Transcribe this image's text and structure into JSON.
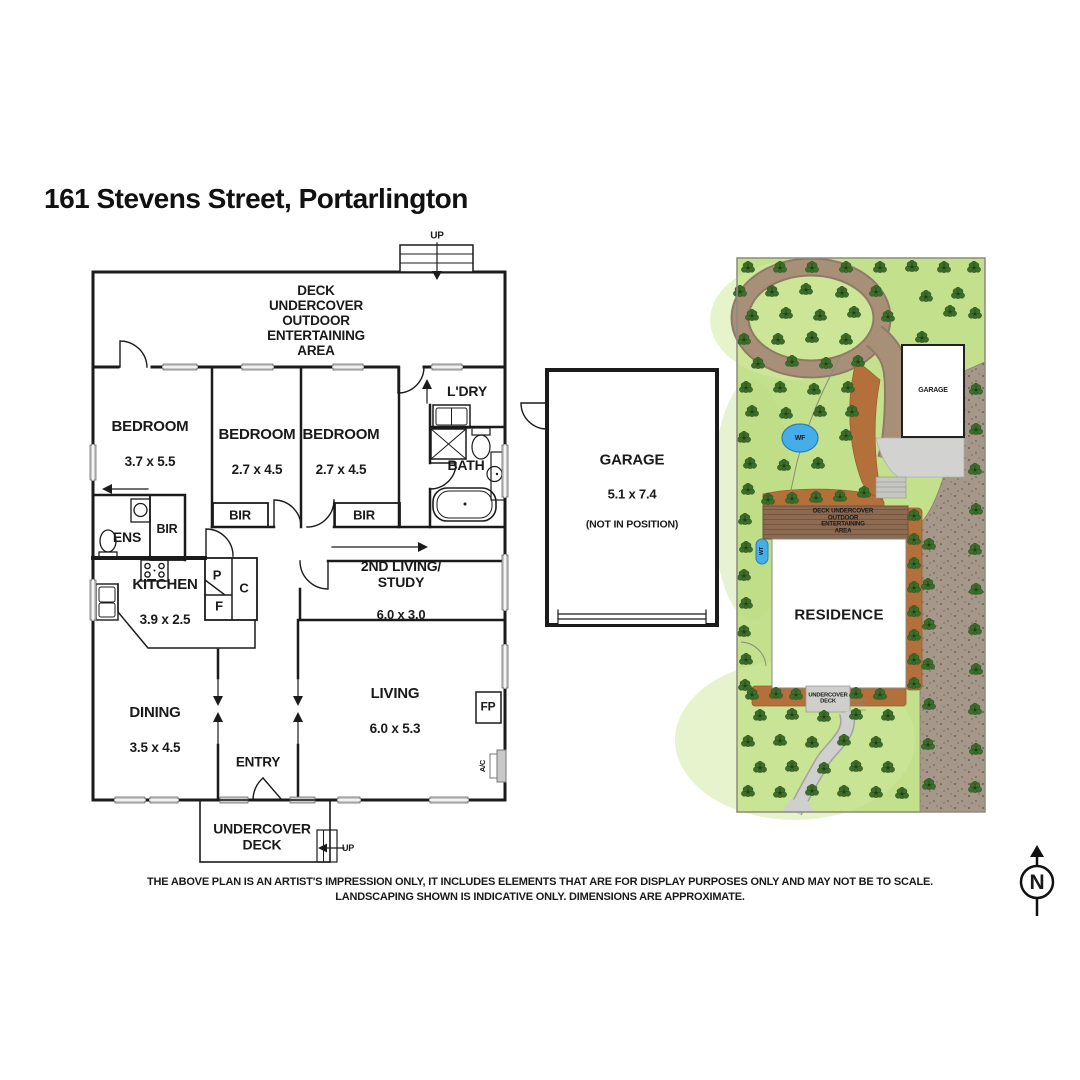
{
  "page_title": "161 Stevens Street, Portarlington",
  "floorplan": {
    "deck_area": "DECK\nUNDERCOVER\nOUTDOOR\nENTERTAINING\nAREA",
    "stairs_top": "UP",
    "stairs_bottom": "UP",
    "rooms": {
      "bedroom1": {
        "name": "BEDROOM",
        "dims": "3.7 x 5.5"
      },
      "bedroom2": {
        "name": "BEDROOM",
        "dims": "2.7 x 4.5"
      },
      "bedroom3": {
        "name": "BEDROOM",
        "dims": "2.7 x 4.5"
      },
      "kitchen": {
        "name": "KITCHEN",
        "dims": "3.9 x 2.5"
      },
      "dining": {
        "name": "DINING",
        "dims": "3.5 x 4.5"
      },
      "living": {
        "name": "LIVING",
        "dims": "6.0 x 5.3"
      },
      "second_living": {
        "name": "2ND LIVING/\nSTUDY",
        "dims": "6.0 x 3.0"
      },
      "garage": {
        "name": "GARAGE",
        "dims": "5.1 x 7.4",
        "note": "(NOT IN POSITION)"
      }
    },
    "labels": {
      "ens": "ENS",
      "bir": "BIR",
      "ldry": "L'DRY",
      "bath": "BATH",
      "pantry": "P",
      "fridge": "F",
      "cupboard": "C",
      "entry": "ENTRY",
      "fireplace": "FP",
      "aircon": "A/C",
      "undercover_deck": "UNDERCOVER\nDECK"
    }
  },
  "siteplan": {
    "labels": {
      "garage": "GARAGE",
      "residence": "RESIDENCE",
      "deck": "DECK UNDERCOVER\nOUTDOOR\nENTERTAINING\nAREA",
      "undercover_deck": "UNDERCOVER\nDECK",
      "water_feature": "WF",
      "water_tank": "WT"
    },
    "colors": {
      "lawn": "#c3e08c",
      "tree": "#3c6e2b",
      "path": "#a89078",
      "garden_bed": "#b4703a",
      "gravel": "#a5988a",
      "deck": "#8d6a52",
      "water": "#45aee8",
      "concrete": "#d2d2d0",
      "wall": "#1b1b1b"
    }
  },
  "compass": {
    "north": "N"
  },
  "disclaimer": {
    "line1": "THE ABOVE PLAN IS AN ARTIST'S IMPRESSION ONLY, IT INCLUDES ELEMENTS THAT ARE FOR DISPLAY PURPOSES ONLY AND MAY NOT BE TO SCALE.",
    "line2": "LANDSCAPING SHOWN IS INDICATIVE ONLY. DIMENSIONS ARE APPROXIMATE."
  }
}
